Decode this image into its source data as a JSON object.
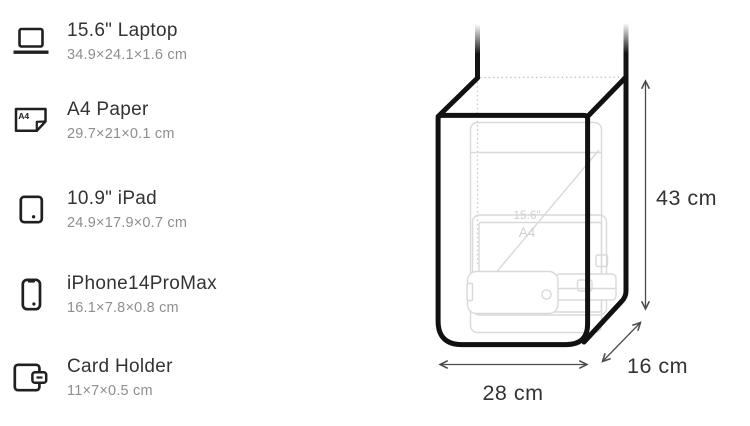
{
  "title_context": "bag capacity size diagram",
  "items": [
    {
      "name": "15.6\" Laptop",
      "dimensions": "34.9×24.1×1.6 cm",
      "icon": "laptop-icon"
    },
    {
      "name": "A4 Paper",
      "dimensions": "29.7×21×0.1 cm",
      "icon": "a4-paper-icon",
      "icon_label": "A4"
    },
    {
      "name": "10.9\" iPad",
      "dimensions": "24.9×17.9×0.7 cm",
      "icon": "ipad-icon"
    },
    {
      "name": "iPhone14ProMax",
      "dimensions": "16.1×7.8×0.8 cm",
      "icon": "iphone-icon"
    },
    {
      "name": "Card Holder",
      "dimensions": "11×7×0.5 cm",
      "icon": "card-holder-icon"
    }
  ],
  "bag": {
    "height_label": "43 cm",
    "width_label": "28 cm",
    "depth_label": "16 cm",
    "inner_labels": {
      "laptop": "15.6\"",
      "a4": "A4"
    }
  },
  "colors": {
    "ink": "#111111",
    "title_text": "#333333",
    "muted_text": "#8e8e8e",
    "ghost_lines": "#d9d9d9"
  }
}
